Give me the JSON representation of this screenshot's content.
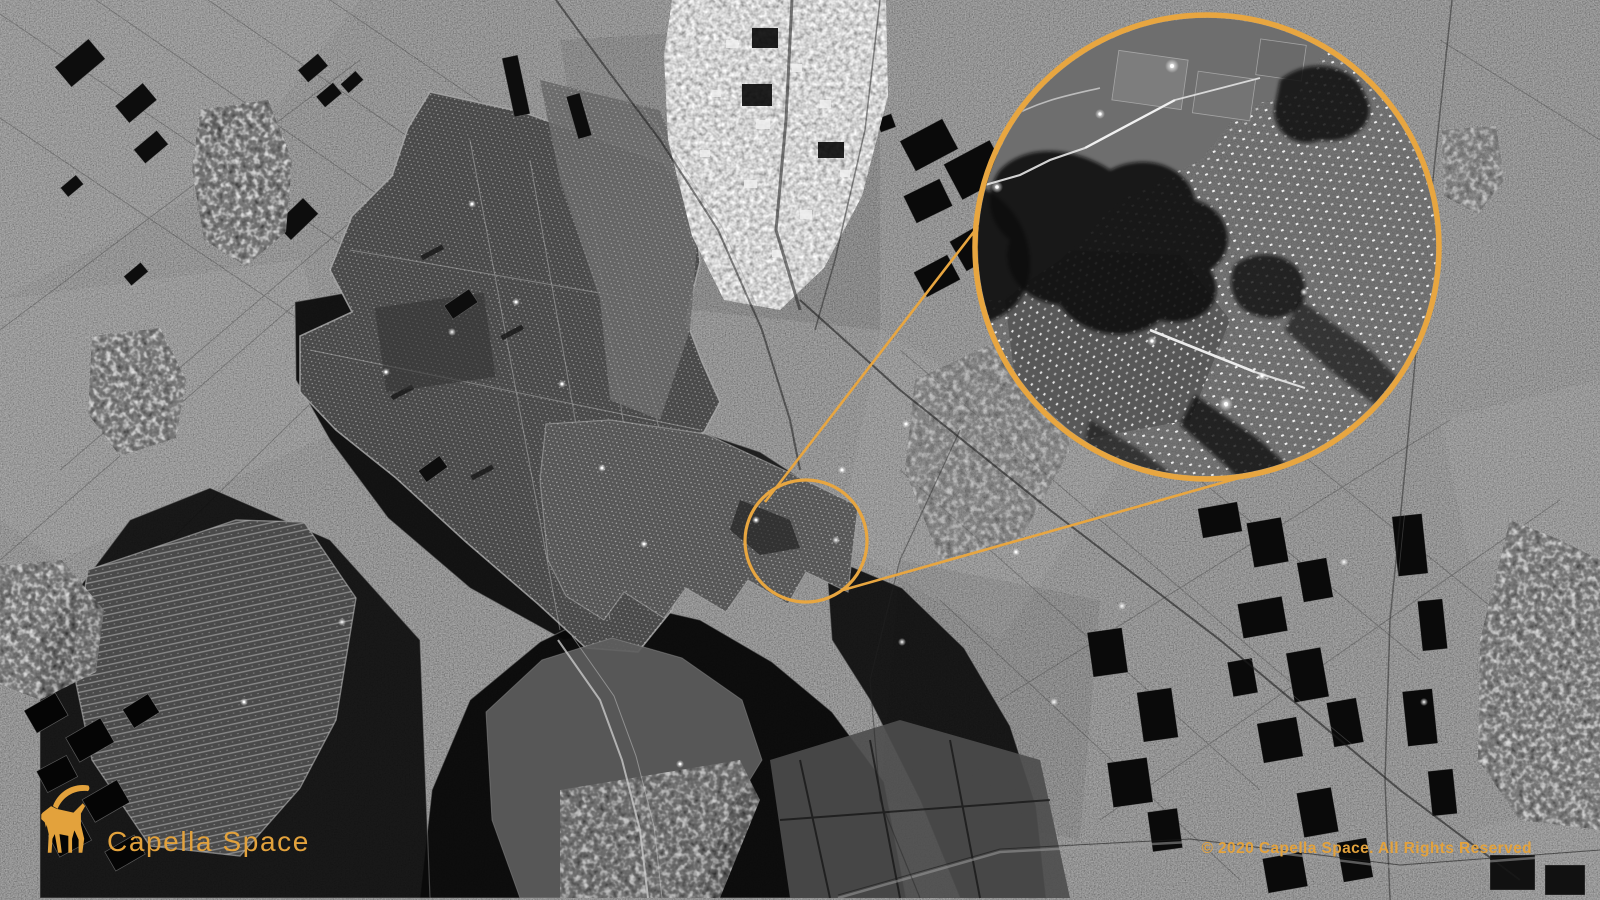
{
  "brand": {
    "name": "Capella Space",
    "color": "#E3A23C",
    "icon": "capella-ibex-icon"
  },
  "annotation": {
    "color": "#E8A640"
  },
  "footer": {
    "copyright": "© 2020 Capella Space. All Rights Reserved"
  }
}
